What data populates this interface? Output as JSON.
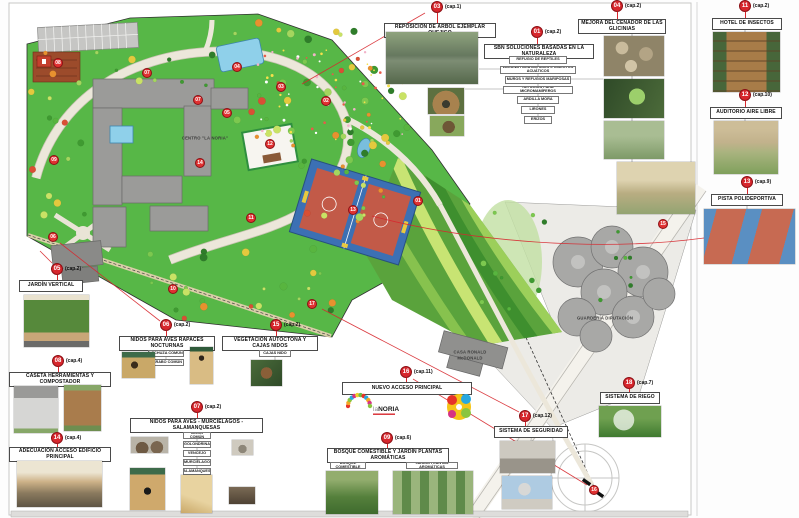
{
  "colors": {
    "marker_red": "#d7272d",
    "park_green": "#57b747",
    "building_gray": "#9b9b99",
    "court_blue": "#3c70b4",
    "court_red": "#c25a48",
    "pool_blue": "#8fd0ea"
  },
  "logo": {
    "prefix": "la",
    "name": "NORIA"
  },
  "map": {
    "building_labels": [
      {
        "id": "centro",
        "text": "CENTRO \"LA NORIA\"",
        "x": 205,
        "y": 138
      },
      {
        "id": "casa-ronald-1",
        "text": "CASA RONALD",
        "x": 470,
        "y": 352
      },
      {
        "id": "casa-ronald-2",
        "text": "McDONALD",
        "x": 470,
        "y": 358
      },
      {
        "id": "guarderia",
        "text": "GUARDERÍA DIPUTACIÓN",
        "x": 605,
        "y": 318
      }
    ],
    "markers": [
      {
        "n": "08",
        "x": 58,
        "y": 63
      },
      {
        "n": "07",
        "x": 147,
        "y": 73
      },
      {
        "n": "04",
        "x": 237,
        "y": 67
      },
      {
        "n": "07",
        "x": 198,
        "y": 100
      },
      {
        "n": "05",
        "x": 227,
        "y": 113
      },
      {
        "n": "03",
        "x": 281,
        "y": 87
      },
      {
        "n": "02",
        "x": 326,
        "y": 101
      },
      {
        "n": "12",
        "x": 270,
        "y": 144
      },
      {
        "n": "09",
        "x": 54,
        "y": 160
      },
      {
        "n": "14",
        "x": 200,
        "y": 163
      },
      {
        "n": "01",
        "x": 418,
        "y": 201
      },
      {
        "n": "13",
        "x": 353,
        "y": 210
      },
      {
        "n": "11",
        "x": 251,
        "y": 218
      },
      {
        "n": "06",
        "x": 53,
        "y": 237
      },
      {
        "n": "10",
        "x": 173,
        "y": 289
      },
      {
        "n": "17",
        "x": 312,
        "y": 304
      },
      {
        "n": "15",
        "x": 663,
        "y": 224
      },
      {
        "n": "16",
        "x": 594,
        "y": 490
      }
    ]
  },
  "panels": [
    {
      "id": "sbn",
      "num": "01",
      "cap": "(cap.2)",
      "marker": {
        "x": 537,
        "y": 32
      },
      "title": {
        "x": 484,
        "y": 44,
        "w": 110,
        "h": 13,
        "text": "SBN  SOLUCIONES BASADAS EN LA NATURALEZA"
      },
      "subs": [
        {
          "t": "REFUGIO DE REPTILES",
          "x": 509,
          "y": 56,
          "w": 58,
          "h": 8
        },
        {
          "t": "LAGUNA PARA ANFIBIOS E INSECTOS ACUÁTICOS",
          "x": 500,
          "y": 66,
          "w": 76,
          "h": 8
        },
        {
          "t": "MUROS Y REFUGIOS MARIPOSAS",
          "x": 505,
          "y": 76,
          "w": 66,
          "h": 8
        },
        {
          "t": "REFUGIOS PARA MICROMAMÍFEROS",
          "x": 503,
          "y": 86,
          "w": 70,
          "h": 8
        },
        {
          "t": "ARDILLA MORA",
          "x": 517,
          "y": 96,
          "w": 42,
          "h": 8
        },
        {
          "t": "LIRONES",
          "x": 521,
          "y": 106,
          "w": 34,
          "h": 8
        },
        {
          "t": "ERIZOS",
          "x": 524,
          "y": 116,
          "w": 28,
          "h": 8
        }
      ],
      "photos": []
    },
    {
      "id": "reposicion-arbol",
      "num": "03",
      "cap": "(cap.1)",
      "marker": {
        "x": 437,
        "y": 7
      },
      "title": {
        "x": 384,
        "y": 23,
        "w": 112,
        "h": 13,
        "text": "REPOSICIÓN DE ÁRBOL EJEMPLAR QUEJIGO"
      },
      "photos": [
        {
          "k": "pond",
          "x": 386,
          "y": 32,
          "w": 92,
          "h": 52
        },
        {
          "k": "dome",
          "x": 428,
          "y": 88,
          "w": 36,
          "h": 26
        },
        {
          "k": "hedgehog",
          "x": 430,
          "y": 116,
          "w": 34,
          "h": 20
        }
      ]
    },
    {
      "id": "cenador-glicinias",
      "num": "04",
      "cap": "(cap.2)",
      "marker": {
        "x": 617,
        "y": 6
      },
      "title": {
        "x": 578,
        "y": 19,
        "w": 88,
        "h": 12,
        "text": "MEJORA DEL CENADOR DE LAS GLICINIAS"
      },
      "photos": [
        {
          "k": "rocks",
          "x": 604,
          "y": 36,
          "w": 60,
          "h": 40
        },
        {
          "k": "birdhouse",
          "x": 604,
          "y": 79,
          "w": 60,
          "h": 39
        },
        {
          "k": "pergola",
          "x": 604,
          "y": 121,
          "w": 60,
          "h": 38
        },
        {
          "k": "bench",
          "x": 617,
          "y": 162,
          "w": 78,
          "h": 52
        }
      ]
    },
    {
      "id": "hotel-insectos",
      "num": "11",
      "cap": "(cap.2)",
      "marker": {
        "x": 745,
        "y": 6
      },
      "title": {
        "x": 712,
        "y": 18,
        "w": 70,
        "h": 12,
        "text": "HOTEL DE INSECTOS"
      },
      "photos": [
        {
          "k": "insect-hotel",
          "x": 713,
          "y": 32,
          "w": 67,
          "h": 60
        }
      ]
    },
    {
      "id": "auditorio",
      "num": "12",
      "cap": "(cap.10)",
      "marker": {
        "x": 745,
        "y": 95
      },
      "title": {
        "x": 710,
        "y": 107,
        "w": 72,
        "h": 12,
        "text": "AUDITORIO AIRE LIBRE"
      },
      "photos": [
        {
          "k": "amphitheater",
          "x": 714,
          "y": 121,
          "w": 64,
          "h": 53
        }
      ]
    },
    {
      "id": "pista-polideportiva",
      "num": "13",
      "cap": "(cap.9)",
      "marker": {
        "x": 747,
        "y": 182
      },
      "title": {
        "x": 711,
        "y": 194,
        "w": 72,
        "h": 12,
        "text": "PISTA POLIDEPORTIVA"
      },
      "photos": [
        {
          "k": "courts",
          "x": 704,
          "y": 209,
          "w": 91,
          "h": 55
        }
      ]
    },
    {
      "id": "jardin-vertical",
      "num": "05",
      "cap": "(cap.2)",
      "marker": {
        "x": 57,
        "y": 269
      },
      "title": {
        "x": 19,
        "y": 280,
        "w": 64,
        "h": 12,
        "text": "JARDÍN VERTICAL"
      },
      "photos": [
        {
          "k": "green-wall",
          "x": 24,
          "y": 295,
          "w": 65,
          "h": 52
        }
      ]
    },
    {
      "id": "caseta-compostador",
      "num": "08",
      "cap": "(cap.4)",
      "marker": {
        "x": 58,
        "y": 361
      },
      "title": {
        "x": 9,
        "y": 372,
        "w": 102,
        "h": 12,
        "text": "CASETA HERRAMIENTAS Y COMPOSTADOR"
      },
      "photos": [
        {
          "k": "shed",
          "x": 14,
          "y": 386,
          "w": 44,
          "h": 47
        },
        {
          "k": "composter",
          "x": 64,
          "y": 385,
          "w": 37,
          "h": 46
        }
      ]
    },
    {
      "id": "acceso-edificio",
      "num": "14",
      "cap": "(cap.4)",
      "marker": {
        "x": 57,
        "y": 438
      },
      "title": {
        "x": 9,
        "y": 447,
        "w": 102,
        "h": 12,
        "text": "ADECUACIÓN ACCESO EDIFICIO PRINCIPAL"
      },
      "photos": [
        {
          "k": "entrance",
          "x": 17,
          "y": 461,
          "w": 85,
          "h": 46
        }
      ]
    },
    {
      "id": "nidos-rapaces",
      "num": "06",
      "cap": "(cap.2)",
      "marker": {
        "x": 166,
        "y": 325
      },
      "title": {
        "x": 119,
        "y": 336,
        "w": 96,
        "h": 12,
        "text": "NIDOS PARA AVES RAPACES NOCTURNAS"
      },
      "subs": [
        {
          "t": "LECHUZA COMÚN",
          "x": 148,
          "y": 350,
          "w": 36,
          "h": 7
        },
        {
          "t": "CÁRABO COMÚN",
          "x": 148,
          "y": 359,
          "w": 36,
          "h": 7
        }
      ],
      "photos": [
        {
          "k": "owl-box",
          "x": 122,
          "y": 352,
          "w": 33,
          "h": 26
        },
        {
          "k": "nest-box-tall",
          "x": 190,
          "y": 347,
          "w": 23,
          "h": 37
        }
      ]
    },
    {
      "id": "vegetacion-autoctona",
      "num": "15",
      "cap": "(cap.2)",
      "marker": {
        "x": 276,
        "y": 325
      },
      "title": {
        "x": 222,
        "y": 336,
        "w": 96,
        "h": 12,
        "text": "VEGETACIÓN AUTÓCTONA Y CAJAS NIDOS"
      },
      "subs": [
        {
          "t": "CAJAS NIDO",
          "x": 259,
          "y": 350,
          "w": 32,
          "h": 7
        }
      ],
      "photos": [
        {
          "k": "nestbox-tree",
          "x": 251,
          "y": 360,
          "w": 31,
          "h": 26
        }
      ]
    },
    {
      "id": "nidos-aves",
      "num": "07",
      "cap": "(cap.2)",
      "marker": {
        "x": 197,
        "y": 407
      },
      "title": {
        "x": 130,
        "y": 418,
        "w": 133,
        "h": 13,
        "text": "NIDOS PARA AVES - MURCIÉLAGOS - SALAMANQUESAS"
      },
      "subs": [
        {
          "t": "AVIÓN COMÚN",
          "x": 183,
          "y": 432,
          "w": 28,
          "h": 7
        },
        {
          "t": "GOLONDRINA",
          "x": 183,
          "y": 441,
          "w": 28,
          "h": 7
        },
        {
          "t": "VENCEJO",
          "x": 183,
          "y": 450,
          "w": 28,
          "h": 7
        },
        {
          "t": "MURCIÉLAGO",
          "x": 183,
          "y": 459,
          "w": 28,
          "h": 7
        },
        {
          "t": "SALAMANQUESA",
          "x": 183,
          "y": 468,
          "w": 28,
          "h": 7
        }
      ],
      "photos": [
        {
          "k": "mud-nests",
          "x": 131,
          "y": 437,
          "w": 37,
          "h": 16
        },
        {
          "k": "swift-cup",
          "x": 232,
          "y": 440,
          "w": 21,
          "h": 15
        },
        {
          "k": "bat-box",
          "x": 130,
          "y": 468,
          "w": 35,
          "h": 42
        },
        {
          "k": "wood-box",
          "x": 181,
          "y": 475,
          "w": 31,
          "h": 38
        },
        {
          "k": "dark-box",
          "x": 229,
          "y": 487,
          "w": 26,
          "h": 17
        }
      ]
    },
    {
      "id": "nuevo-acceso",
      "num": "16",
      "cap": "(cap.11)",
      "marker": {
        "x": 406,
        "y": 372
      },
      "title": {
        "x": 342,
        "y": 382,
        "w": 130,
        "h": 13,
        "text": "NUEVO ACCESO PRINCIPAL"
      },
      "logos": true
    },
    {
      "id": "bosque-comestible",
      "num": "09",
      "cap": "(cap.6)",
      "marker": {
        "x": 387,
        "y": 438
      },
      "title": {
        "x": 327,
        "y": 448,
        "w": 122,
        "h": 12,
        "text": "BOSQUE COMESTIBLE Y JARDÍN PLANTAS AROMÁTICAS"
      },
      "subs": [
        {
          "t": "BOSQUE COMESTIBLE",
          "x": 330,
          "y": 462,
          "w": 36,
          "h": 7
        },
        {
          "t": "JARDÍN PLANTAS AROMÁTICAS",
          "x": 406,
          "y": 462,
          "w": 52,
          "h": 7
        }
      ],
      "photos": [
        {
          "k": "shrubs",
          "x": 326,
          "y": 471,
          "w": 52,
          "h": 43
        },
        {
          "k": "aromatics",
          "x": 393,
          "y": 471,
          "w": 80,
          "h": 43
        }
      ]
    },
    {
      "id": "sistema-seguridad",
      "num": "17",
      "cap": "(cap.12)",
      "marker": {
        "x": 525,
        "y": 416
      },
      "title": {
        "x": 494,
        "y": 426,
        "w": 74,
        "h": 12,
        "text": "SISTEMA DE SEGURIDAD"
      },
      "photos": [
        {
          "k": "barrier",
          "x": 500,
          "y": 441,
          "w": 55,
          "h": 32
        },
        {
          "k": "camera",
          "x": 502,
          "y": 476,
          "w": 50,
          "h": 33
        }
      ]
    },
    {
      "id": "sistema-riego",
      "num": "18",
      "cap": "(cap.7)",
      "marker": {
        "x": 629,
        "y": 383
      },
      "title": {
        "x": 600,
        "y": 392,
        "w": 60,
        "h": 12,
        "text": "SISTEMA DE RIEGO"
      },
      "photos": [
        {
          "k": "sprinkler",
          "x": 599,
          "y": 406,
          "w": 62,
          "h": 31
        }
      ]
    }
  ]
}
